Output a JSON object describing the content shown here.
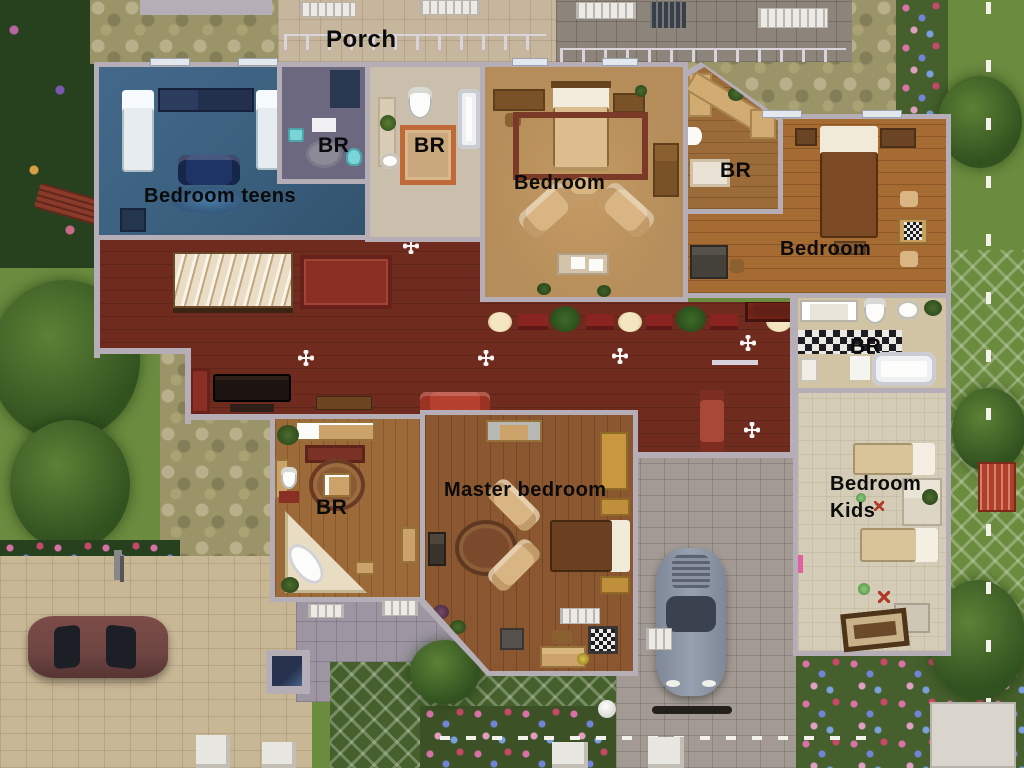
{
  "scene": "the-sims-house-floorplan-overhead",
  "labels": {
    "porch": "Porch",
    "bedroom_teens": "Bedroom teens",
    "br_teen_bath": "BR",
    "br_main_bath": "BR",
    "bedroom_main": "Bedroom",
    "br_corner_bath": "BR",
    "bedroom_right": "Bedroom",
    "br_right_bath": "BR",
    "master_bedroom": "Master bedroom",
    "br_master_bath": "BR",
    "bedroom_kids_line1": "Bedroom",
    "bedroom_kids_line2": "Kids"
  },
  "colors": {
    "wall": "#b6aeb6",
    "hall": "#6e2b1e",
    "teen": "#3a607e",
    "teen_bath": "#6b6880",
    "bath_beige": "#cabfac",
    "bedroom_tan": "#b48d5a",
    "wood": "#a56b33",
    "wood_dark": "#8a5730",
    "bath5_wood": "#9c6a38",
    "tr_bath_wood": "#9c6b3a",
    "kids_floor": "#d4ccb6",
    "bath_right": "#d0c4a4",
    "lawn": "#6b8c3f",
    "lawn_dark": "#45602c",
    "foliage": "#27411f",
    "cobble": "#9a9468",
    "paver_beige": "#c8b795",
    "paver_gray": "#a29a93",
    "patio": "#9d96a2",
    "label": "#0b0b0b",
    "red_rug": "#8a2f24",
    "couch_red": "#b5402e",
    "plant": "#3e6428",
    "car_maroon": "#6e4542",
    "car_silver": "#97a0ae",
    "bed_white": "#e6ecef",
    "tan_furn": "#d9b583",
    "wood_furn": "#7a5228"
  }
}
